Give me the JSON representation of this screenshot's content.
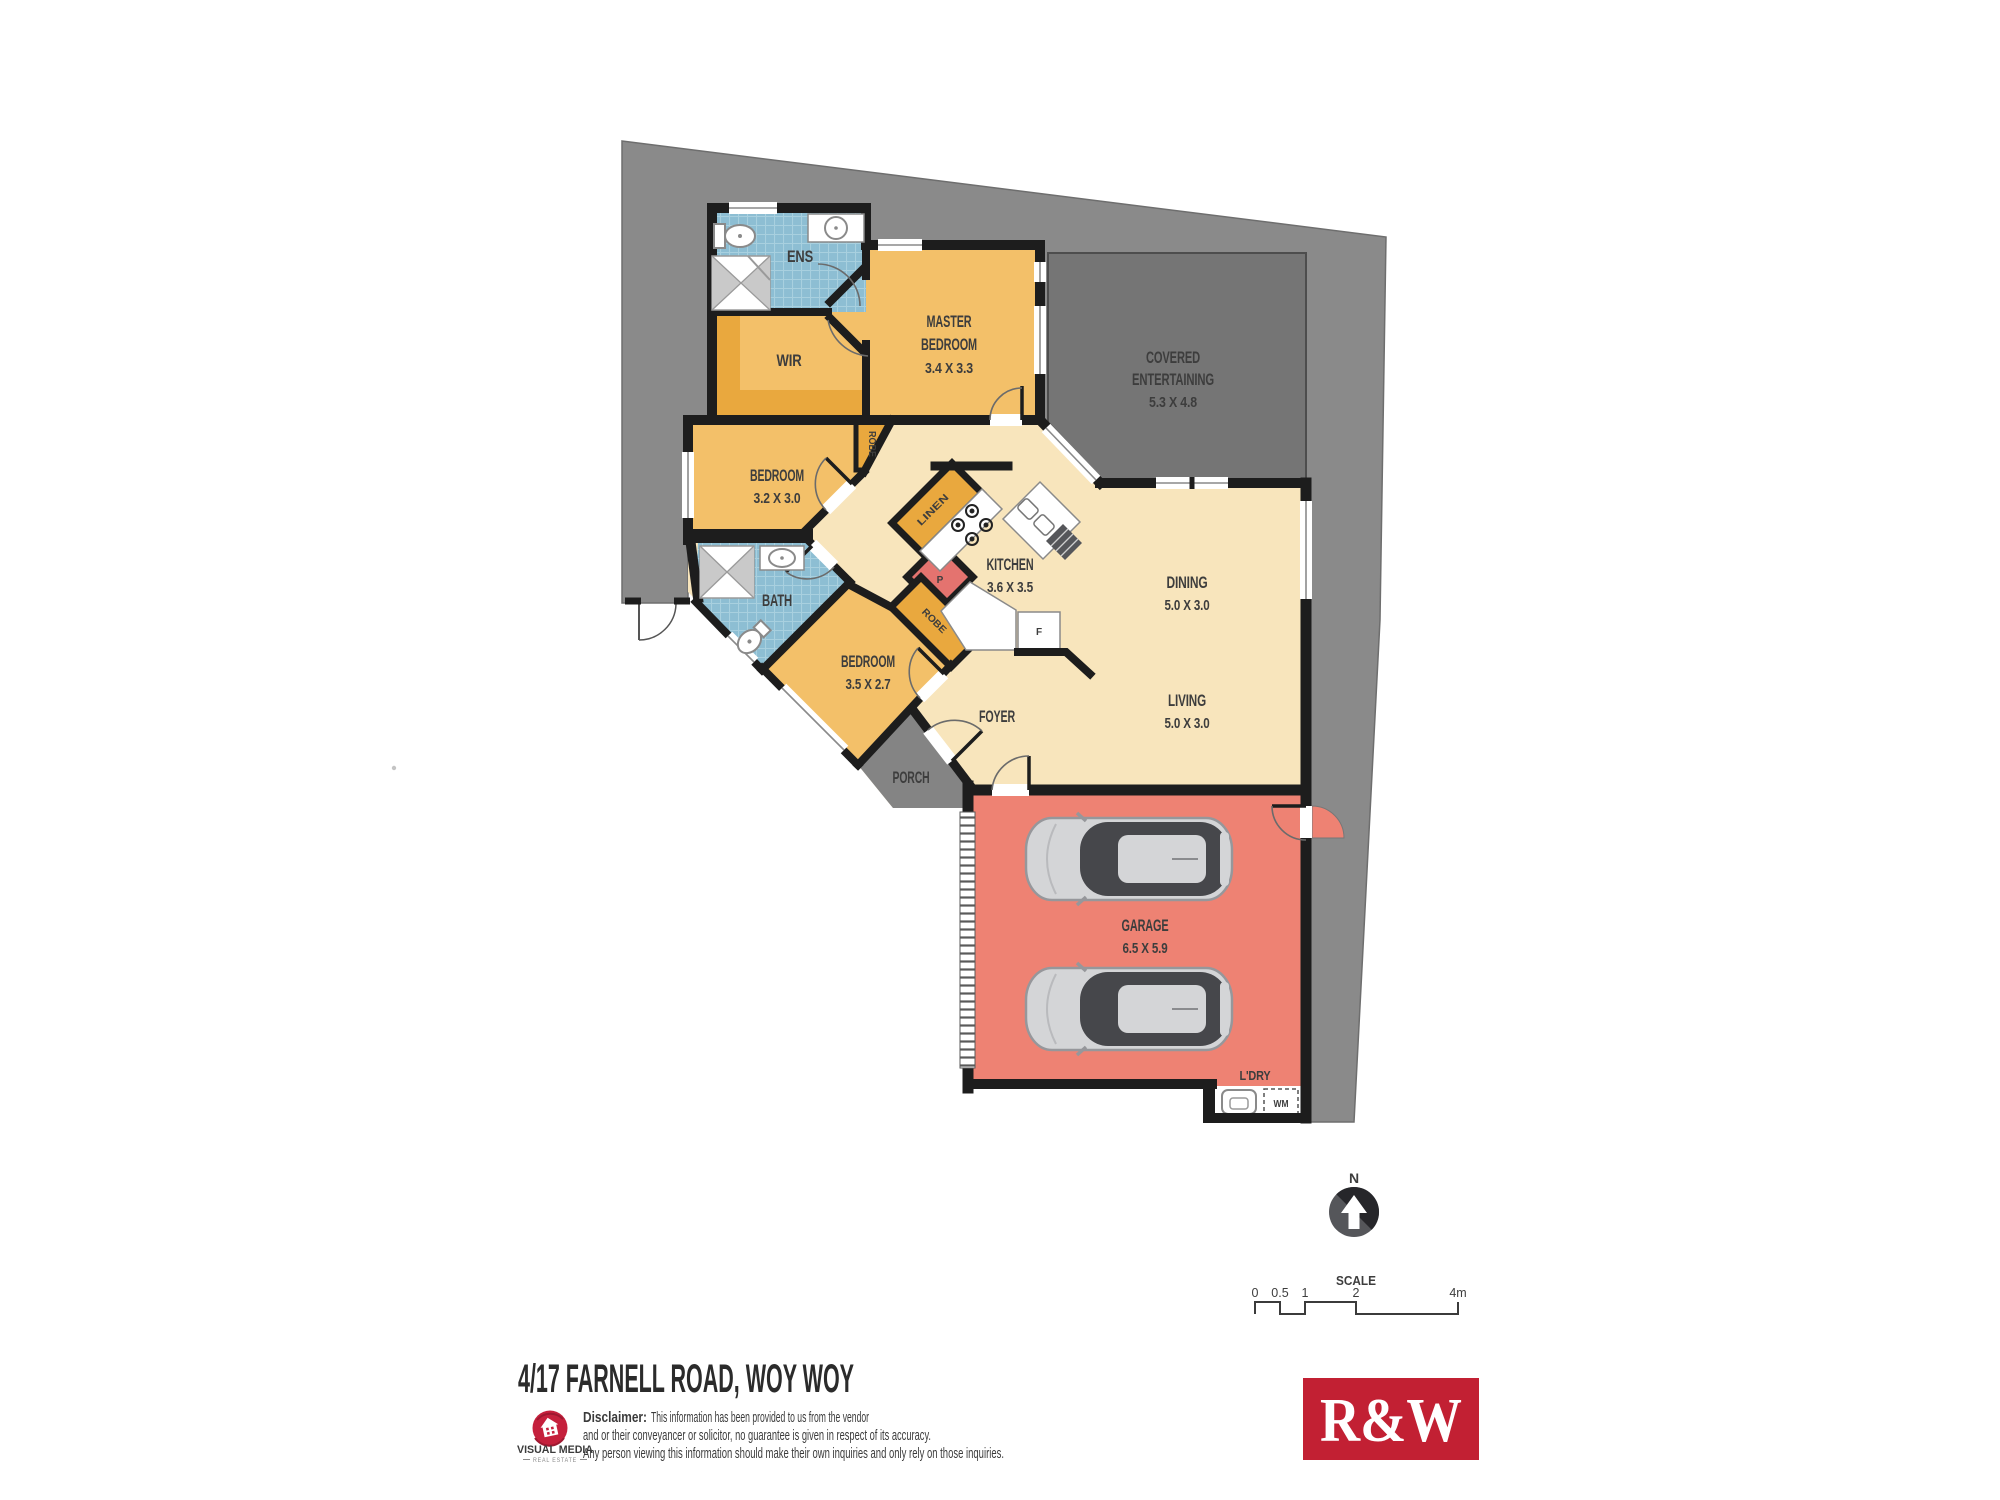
{
  "plan": {
    "rooms": {
      "ens": {
        "name": "ENS"
      },
      "wir": {
        "name": "WIR"
      },
      "master_bedroom": {
        "line1": "MASTER",
        "line2": "BEDROOM",
        "dims": "3.4 X 3.3"
      },
      "covered_entertaining": {
        "line1": "COVERED",
        "line2": "ENTERTAINING",
        "dims": "5.3 X 4.8"
      },
      "bedroom_2": {
        "name": "BEDROOM",
        "dims": "3.2 X 3.0"
      },
      "bedroom_3": {
        "name": "BEDROOM",
        "dims": "3.5 X 2.7"
      },
      "bath": {
        "name": "BATH"
      },
      "kitchen": {
        "name": "KITCHEN",
        "dims": "3.6 X 3.5"
      },
      "dining": {
        "name": "DINING",
        "dims": "5.0 X 3.0"
      },
      "living": {
        "name": "LIVING",
        "dims": "5.0 X 3.0"
      },
      "foyer": {
        "name": "FOYER"
      },
      "porch": {
        "name": "PORCH"
      },
      "garage": {
        "name": "GARAGE",
        "dims": "6.5 X 5.9"
      },
      "laundry": {
        "name": "L'DRY"
      }
    },
    "storage": {
      "robe_bed2": "ROBE",
      "linen": "LINEN",
      "pantry": "P",
      "robe_bed3": "ROBE",
      "fridge": "F",
      "washing_machine": "WM"
    },
    "compass": {
      "label": "N"
    },
    "scale_bar": {
      "title": "SCALE",
      "t0": "0",
      "t1": "0.5",
      "t2": "1",
      "t3": "2",
      "t4": "4m"
    }
  },
  "footer": {
    "address": "4/17 FARNELL ROAD, WOY WOY",
    "disclaimer_label": "Disclaimer:",
    "disclaimer_line1": "This information has been provided to us from the vendor",
    "disclaimer_line2": "and or their conveyancer or solicitor, no guarantee is given in respect of its accuracy.",
    "disclaimer_line3": "Any person viewing this information should make their own inquiries and only rely on those inquiries.",
    "vm_logo_title": "VISUAL MEDIA",
    "vm_logo_subtitle": "REAL ESTATE",
    "rw_logo": "R&W"
  },
  "colors": {
    "lot_grey": "#8a8a8a",
    "entertaining_grey": "#757575",
    "porch_grey": "#848484",
    "floor_cream": "#f8e5bc",
    "bedroom_orange": "#f3c069",
    "storage_orange": "#e9a83e",
    "garage_salmon": "#ee8273",
    "pantry_red": "#e4736f",
    "wall_black": "#1d1d1d",
    "rw_red": "#c22033",
    "vm_red": "#c5203c"
  }
}
